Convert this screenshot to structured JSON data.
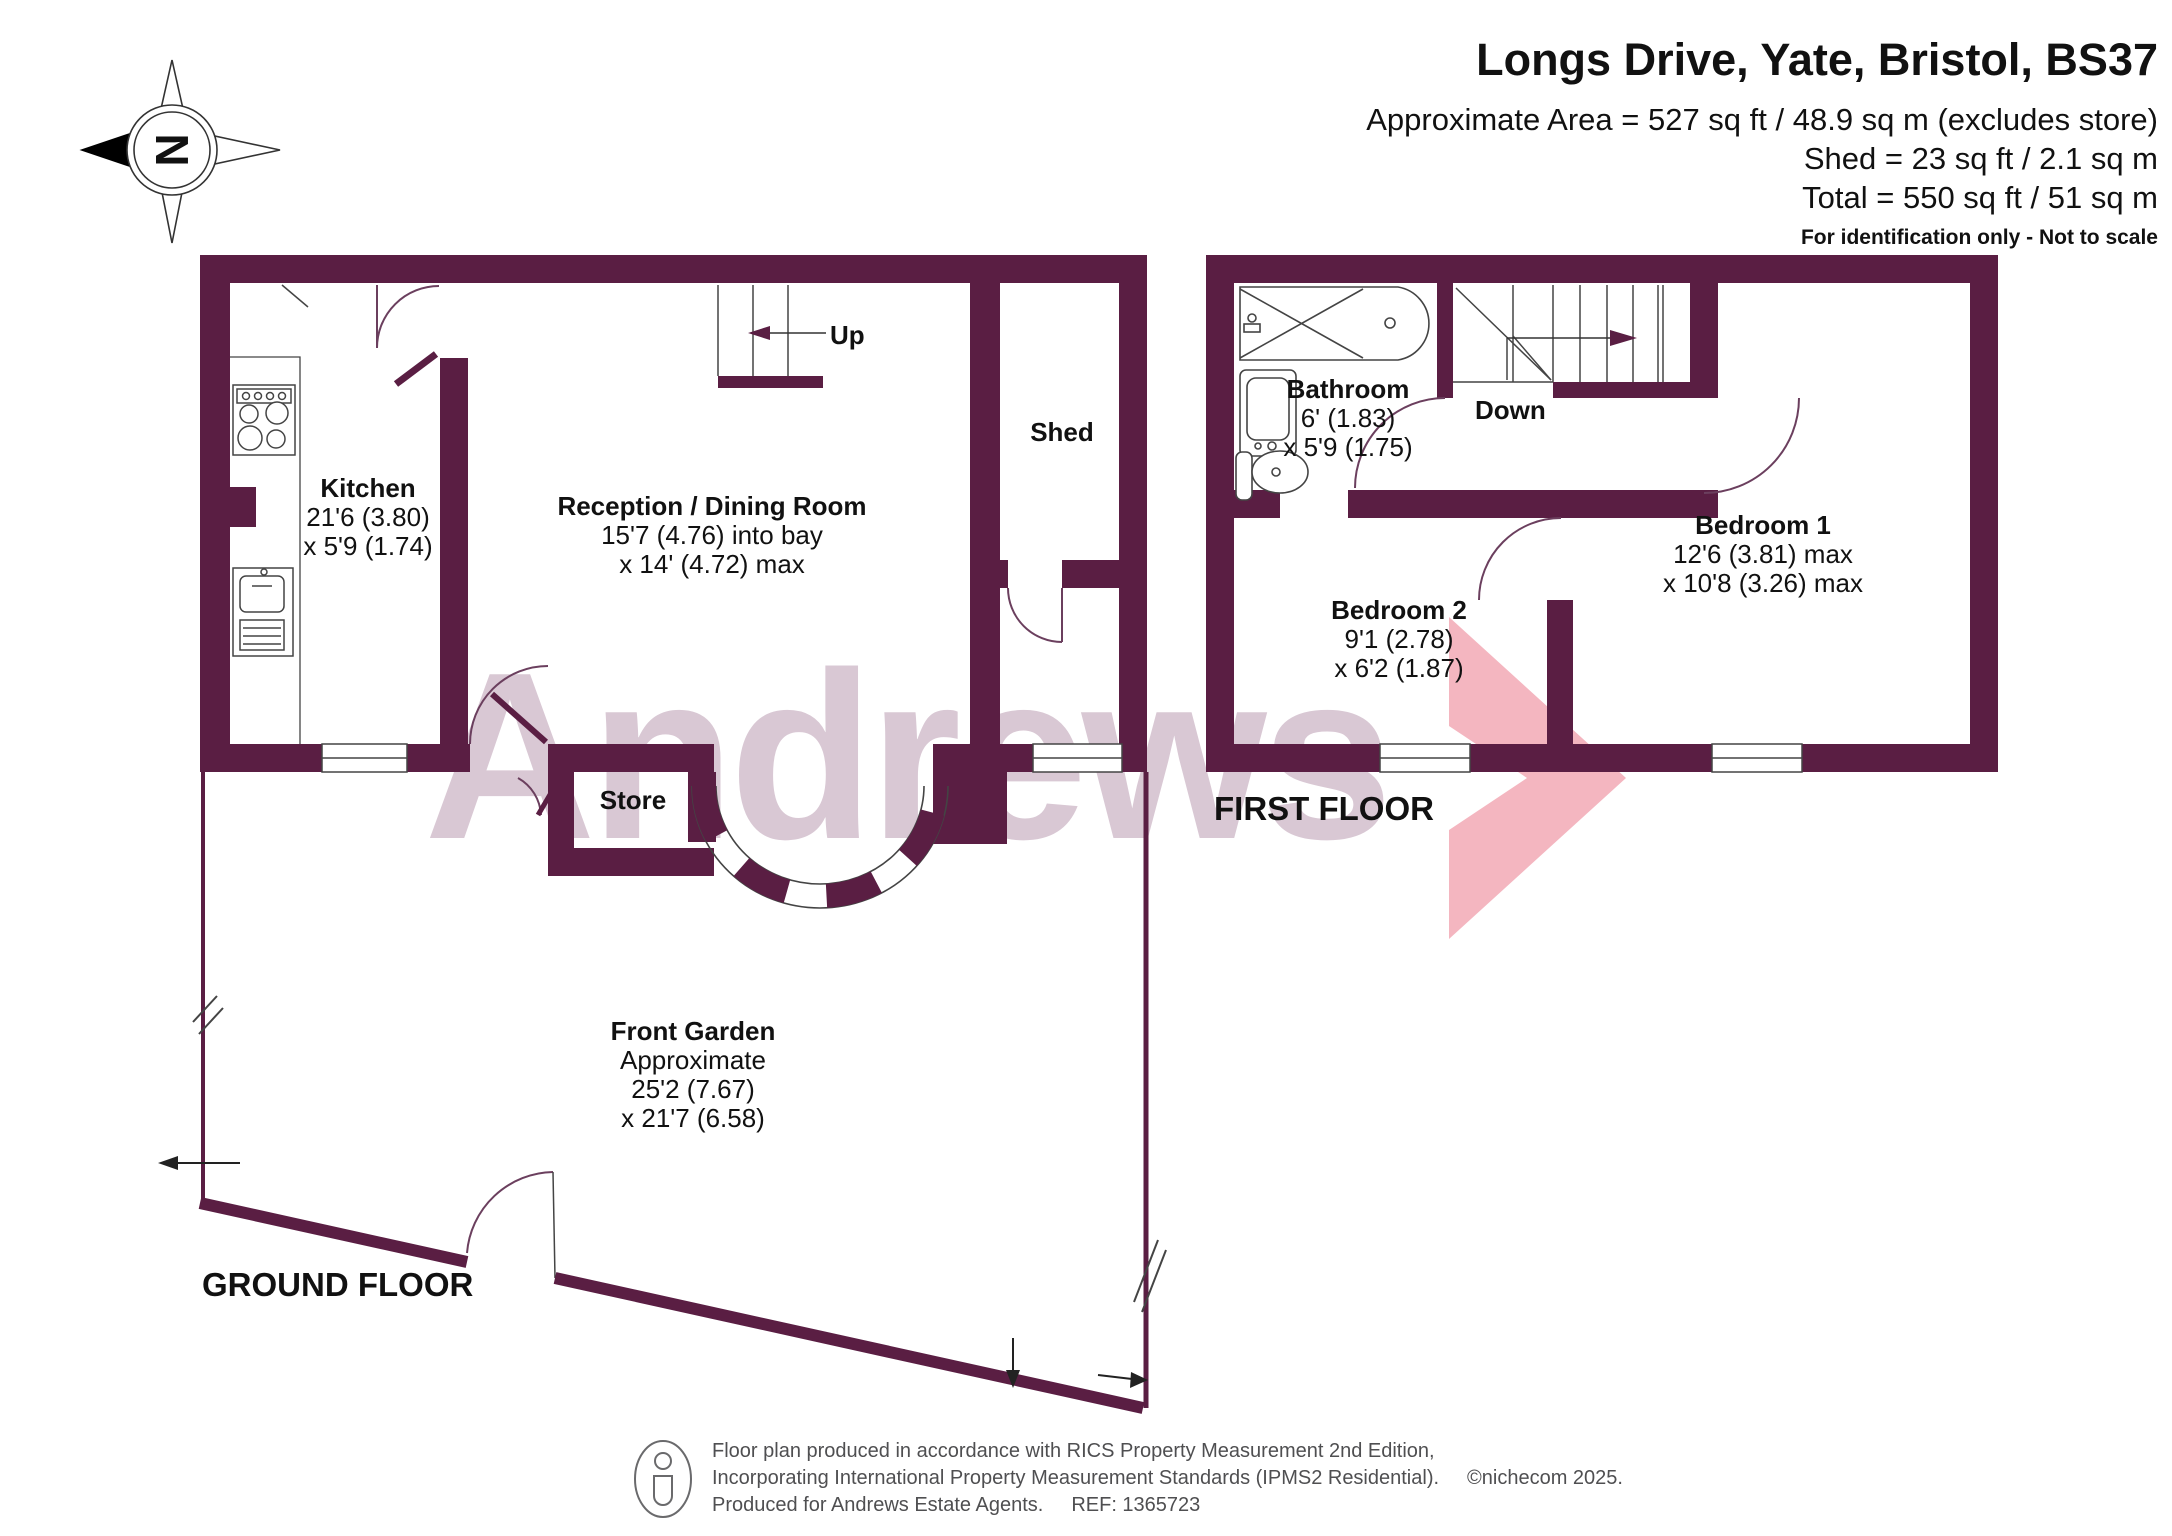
{
  "header": {
    "title": "Longs Drive, Yate, Bristol, BS37",
    "area_line": "Approximate Area = 527 sq ft / 48.9 sq m (excludes store)",
    "shed_line": "Shed = 23 sq ft / 2.1 sq m",
    "total_line": "Total = 550 sq ft / 51 sq m",
    "disclaimer": "For identification only - Not to scale"
  },
  "compass": {
    "letter": "N"
  },
  "watermark": {
    "text": "Andrews"
  },
  "colors": {
    "wall": "#5a1e43",
    "watermark_text": "#d9c8d4",
    "logo_arrow": "#f4b6c0",
    "footer_text": "#4f4f51"
  },
  "floors": {
    "ground": {
      "label": "GROUND FLOOR",
      "kitchen": {
        "name": "Kitchen",
        "dim1": "21'6 (3.80)",
        "dim2": "x 5'9 (1.74)"
      },
      "reception": {
        "name": "Reception / Dining Room",
        "dim1": "15'7 (4.76) into bay",
        "dim2": "x 14' (4.72) max"
      },
      "shed": {
        "name": "Shed"
      },
      "store": {
        "name": "Store"
      },
      "stairs_label": "Up",
      "front_garden": {
        "name": "Front Garden",
        "line1": "Approximate",
        "line2": "25'2 (7.67)",
        "line3": "x 21'7 (6.58)"
      }
    },
    "first": {
      "label": "FIRST FLOOR",
      "bathroom": {
        "name": "Bathroom",
        "dim1": "6' (1.83)",
        "dim2": "x 5'9 (1.75)"
      },
      "bedroom1": {
        "name": "Bedroom 1",
        "dim1": "12'6 (3.81) max",
        "dim2": "x 10'8 (3.26) max"
      },
      "bedroom2": {
        "name": "Bedroom 2",
        "dim1": "9'1 (2.78)",
        "dim2": "x 6'2 (1.87)"
      },
      "stairs_label": "Down"
    }
  },
  "footer": {
    "line1": "Floor plan produced in accordance with RICS Property Measurement 2nd Edition,",
    "line2a": "Incorporating International Property Measurement Standards (IPMS2 Residential).",
    "line2b": "©nichecom 2025.",
    "line3a": "Produced for  Andrews Estate Agents.",
    "line3b": "REF: 1365723"
  }
}
